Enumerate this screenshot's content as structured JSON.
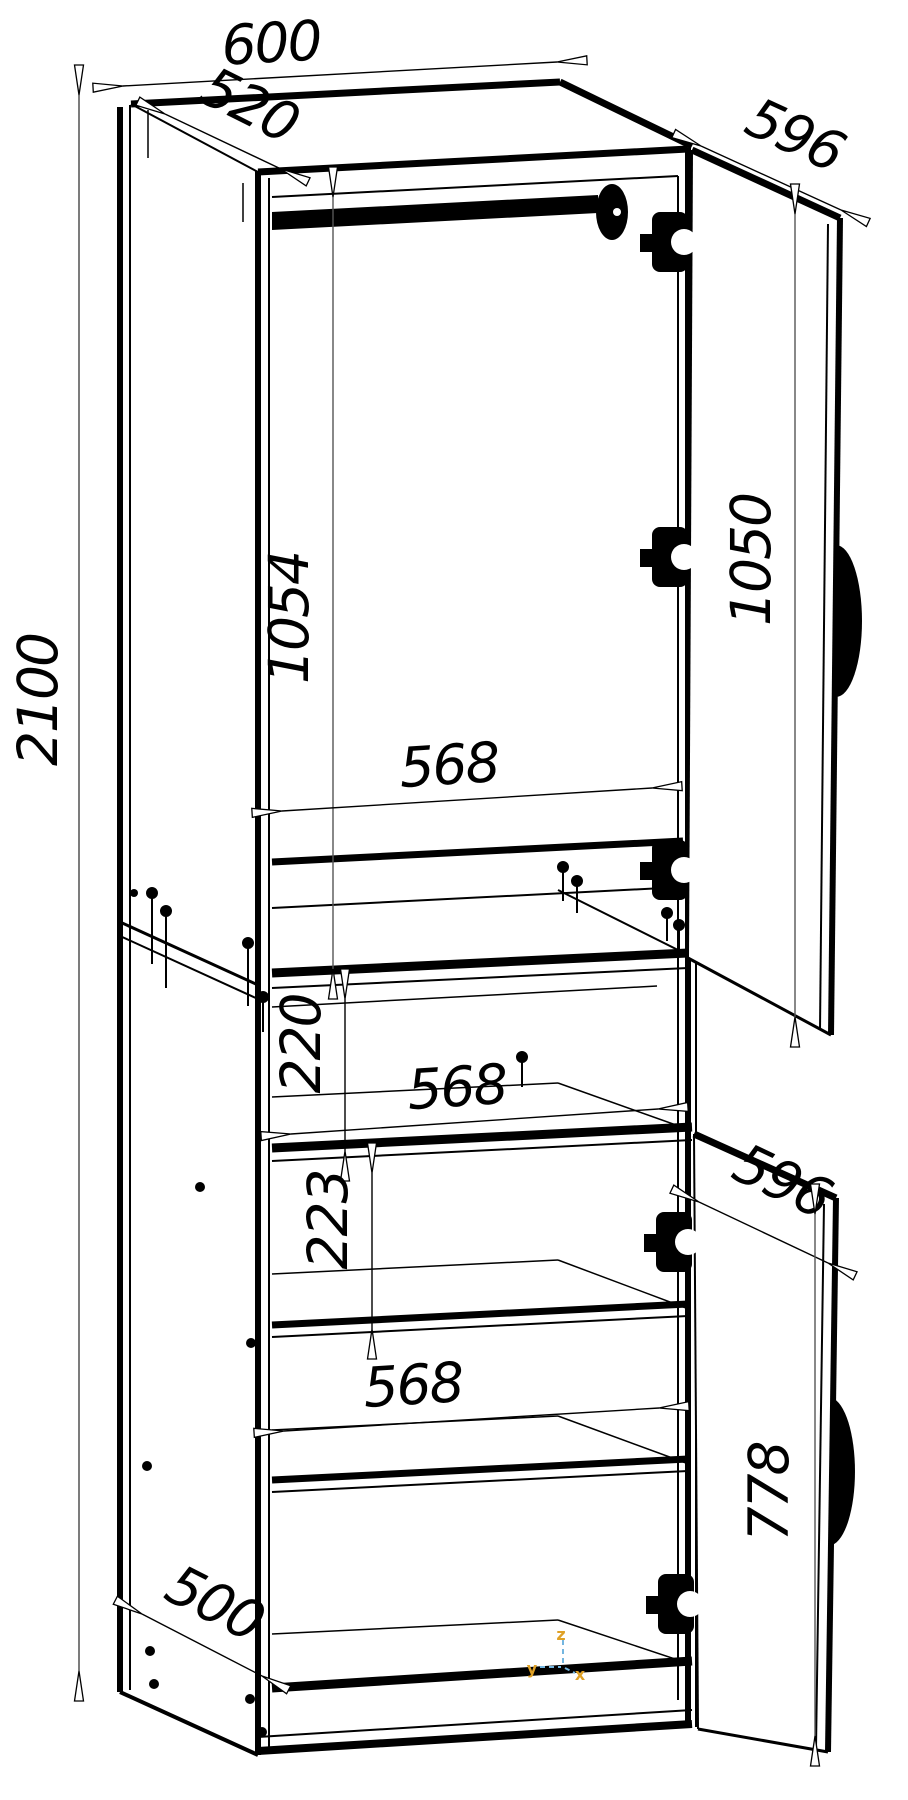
{
  "drawing": {
    "background": "#ffffff",
    "line_color": "#000000",
    "dimensions": {
      "overall_height": "2100",
      "overall_width": "600",
      "top_depth": "520",
      "upper_door_width": "596",
      "upper_door_height": "1050",
      "upper_interior_height": "1054",
      "upper_interior_width": "568",
      "niche_height": "220",
      "niche_interior_width": "568",
      "lower_shelf_spacing": "223",
      "lower_door_width": "596",
      "lower_door_height": "778",
      "lower_interior_width": "568",
      "base_depth": "500"
    },
    "axes": {
      "x_label": "x",
      "y_label": "y",
      "z_label": "z",
      "label_color": "#dfa126",
      "line_color": "#74b6e0"
    }
  }
}
